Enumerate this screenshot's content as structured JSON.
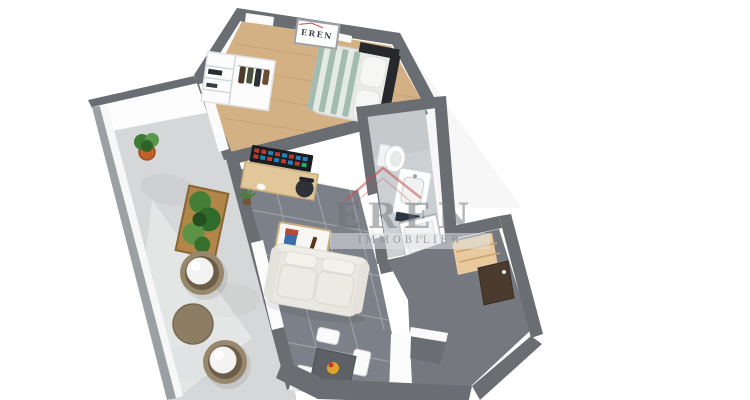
{
  "watermark": {
    "brand": "EREN",
    "tagline": "IMMOBILIER"
  },
  "wall_frame": {
    "text": "EREN"
  },
  "colors": {
    "background": "#ffffff",
    "wall": "#6a6e72",
    "terrace_floor": "#d6d7d8",
    "parapet": "#fdfdfd",
    "wood_floor": "#d4b184",
    "living_floor": "#7c8088",
    "entry_floor": "#75797f",
    "bath_floor": "#ccd0d3",
    "bed_stripe": "#a3bcb1",
    "bed_stripe_light": "#e4eae5",
    "headboard": "#26282b",
    "sofa": "#e9e7e0",
    "coffee_table": "#f7f6f2",
    "guitar": "#7c3b22",
    "dining_table": "#5d6065",
    "fruit": "#e0a32e",
    "planter_wood": "#b08749",
    "plant_green": "#447f35",
    "pot_orange": "#c1622b",
    "round_chair": "#97876c",
    "round_chair_inner": "#6b5d48",
    "round_table": "#8d7d64",
    "doormat": "#e8ca9e",
    "door": "#4b3b2f",
    "cabinet": "#2c3440",
    "monitor": "#1a1c1f",
    "desk": "#e2c79b",
    "wardrobe": "#fcfcfc",
    "accent_red": "#c4504d"
  }
}
